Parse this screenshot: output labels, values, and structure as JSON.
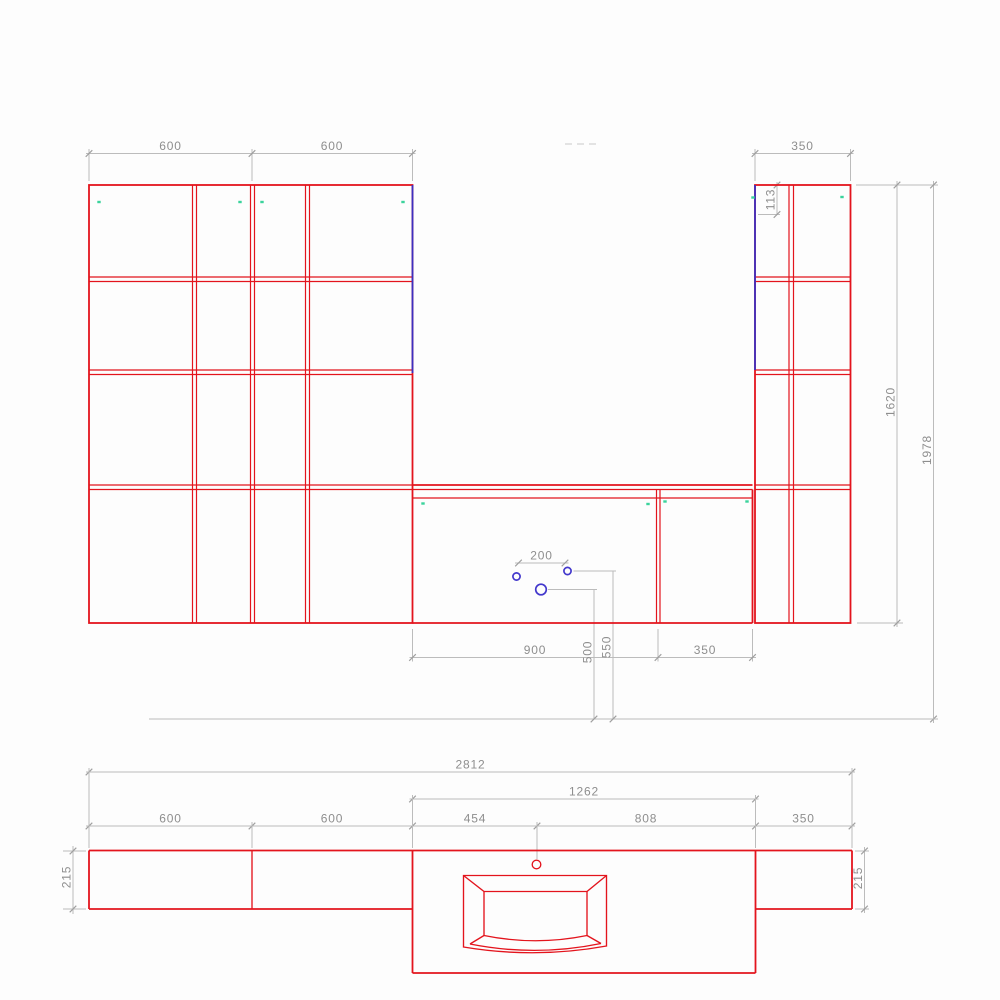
{
  "colors": {
    "cabinet_outline": "#e3141d",
    "accent_edge": "#3c30c0",
    "hole_marker": "#4338cc",
    "hinge_marker": "#3bd39c",
    "dimension_line": "#bcbcbc",
    "dimension_text": "#8e8e8e",
    "background": "#fdfdfd"
  },
  "elevation": {
    "top": {
      "left1": "600",
      "left2": "600",
      "right": "350"
    },
    "top_rail": "113",
    "cabinet_height": "1620",
    "total_height": "1978",
    "bottom": {
      "sink_unit": "900",
      "side_unit": "350"
    },
    "holes": {
      "spacing": "200",
      "height_main": "500",
      "height_side": "550"
    }
  },
  "plan": {
    "total_width": "2812",
    "counter_width": "1262",
    "sections": {
      "s1": "600",
      "s2": "600",
      "s3": "454",
      "s4": "808",
      "s5": "350"
    },
    "depth_left": "215",
    "depth_right": "215"
  }
}
